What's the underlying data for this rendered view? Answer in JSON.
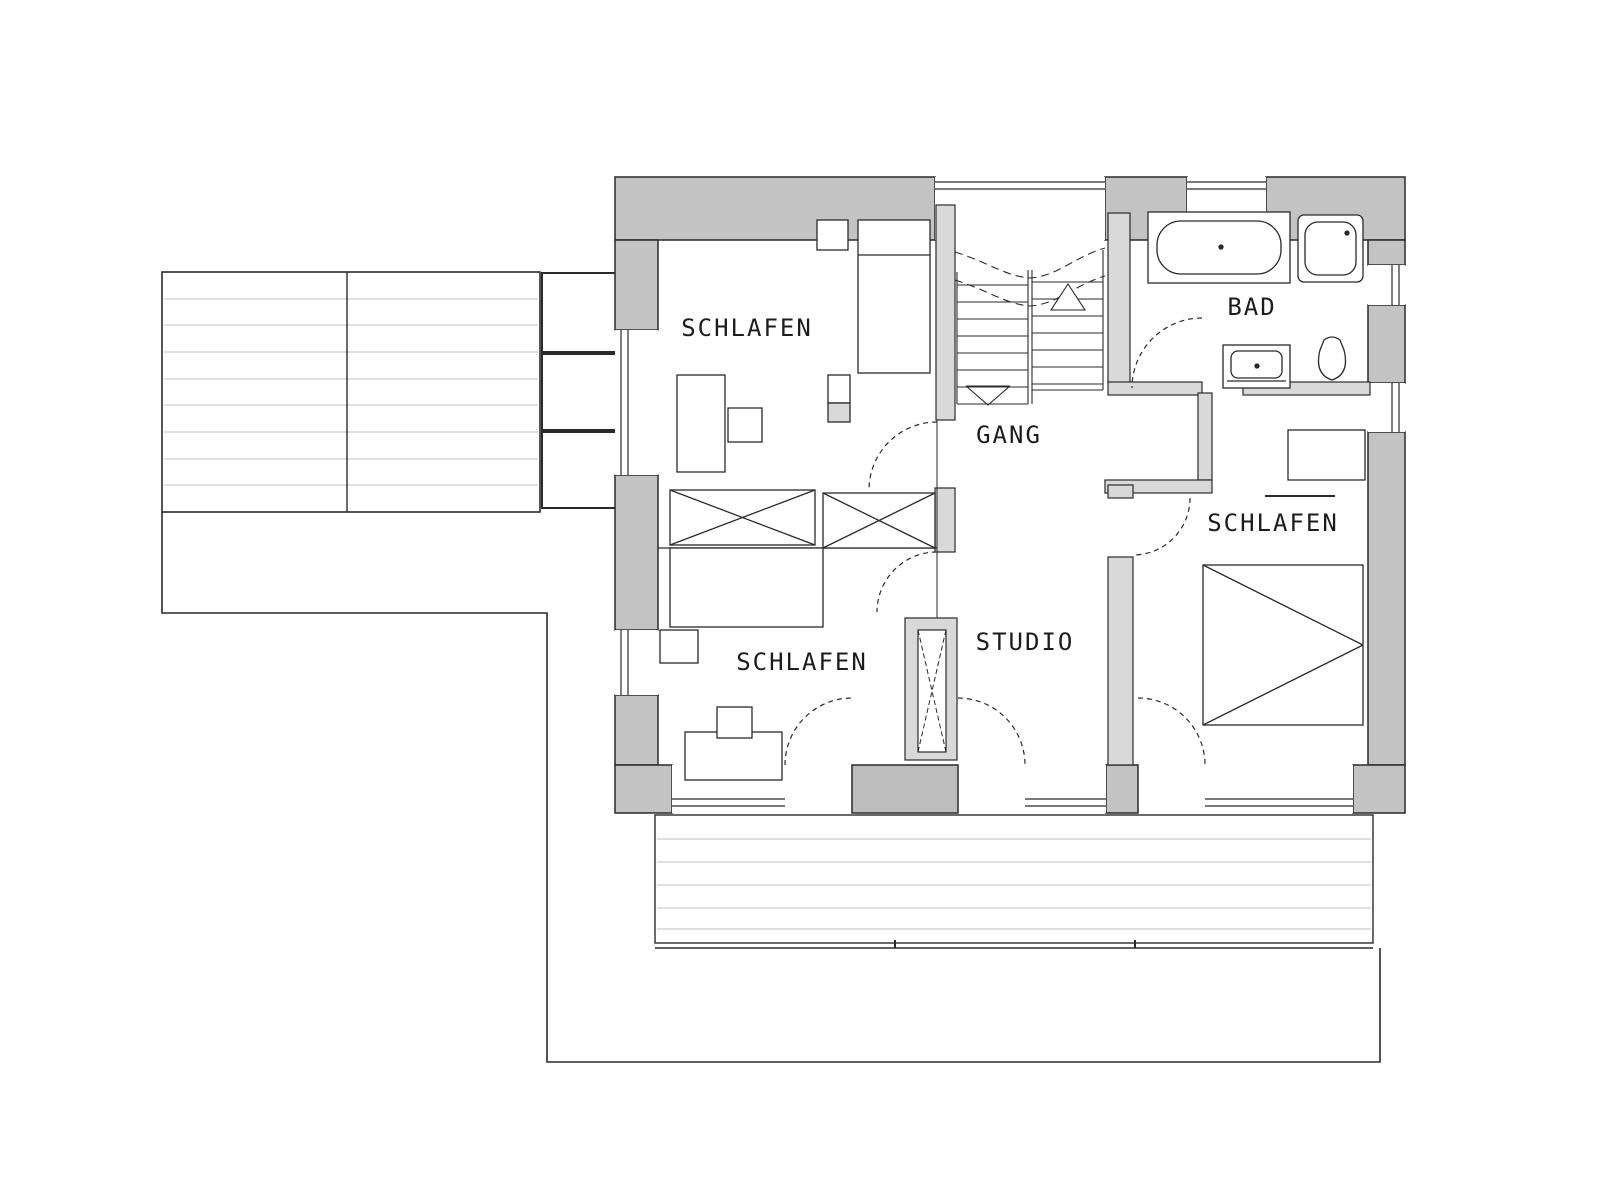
{
  "document": {
    "type": "architectural-floor-plan",
    "language": "de",
    "description": "Upper floor plan with three bedrooms, bathroom, hallway, studio, terrace and balcony"
  },
  "rooms": {
    "schlafen_nw": {
      "label": "SCHLAFEN"
    },
    "schlafen_sw": {
      "label": "SCHLAFEN"
    },
    "schlafen_e": {
      "label": "SCHLAFEN"
    },
    "bad": {
      "label": "BAD"
    },
    "gang": {
      "label": "GANG"
    },
    "studio": {
      "label": "STUDIO"
    }
  },
  "fixtures": {
    "bathroom": [
      "bathtub",
      "shower",
      "washbasin",
      "toilet"
    ],
    "bedrooms": [
      "double-bed",
      "single-bed",
      "bed",
      "desk",
      "chair",
      "wardrobe-x2",
      "tall-wardrobe",
      "dresser"
    ],
    "circulation": [
      "stairs-up-arrow",
      "stairs-down-arrow",
      "door-swing-arcs"
    ],
    "outdoor": [
      "terrace-deck",
      "balcony-deck",
      "planter-boxes",
      "lower-floor-outline"
    ]
  },
  "colors": {
    "background": "#ffffff",
    "exterior_wall": "#c3c3c3",
    "interior_wall": "#d9d9d9",
    "dark_wall_block": "#bdbdbd",
    "line": "#2a2a2a",
    "deck_line": "#dfdfdf",
    "label_text": "#1c1c1c"
  }
}
